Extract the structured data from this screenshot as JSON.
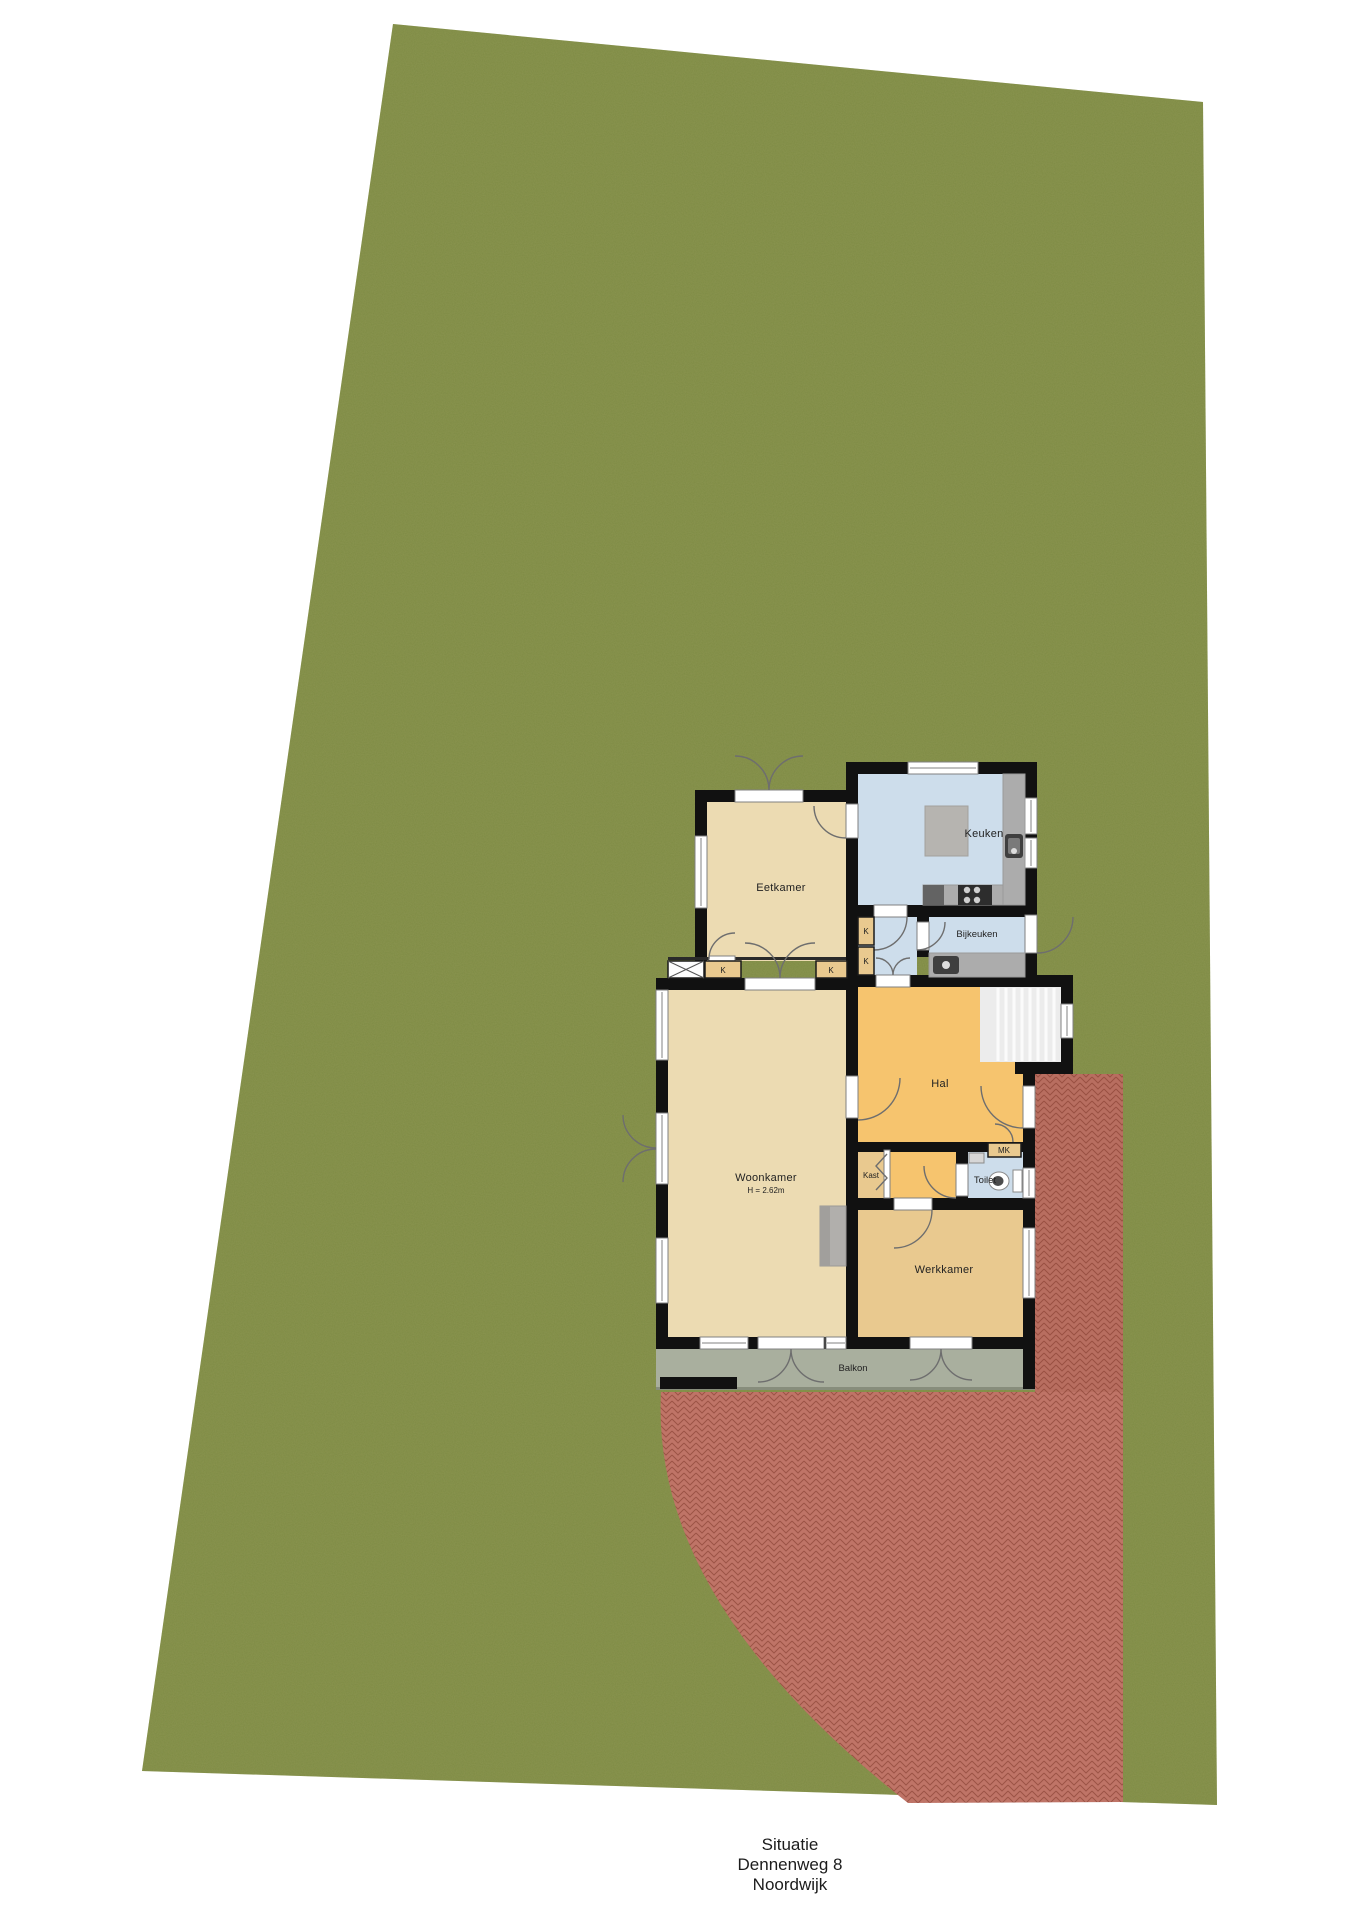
{
  "caption": {
    "line1": "Situatie",
    "line2": "Dennenweg 8",
    "line3": "Noordwijk"
  },
  "rooms": {
    "eetkamer": "Eetkamer",
    "keuken": "Keuken",
    "bijkeuken": "Bijkeuken",
    "hal": "Hal",
    "woonkamer": "Woonkamer",
    "woonkamer_ceiling": "H = 2.62m",
    "werkkamer": "Werkkamer",
    "kast": "Kast",
    "toilet": "Toilet",
    "mk": "MK",
    "balkon": "Balkon",
    "closet_abbr": "K"
  },
  "colors": {
    "grass": "#7e8b44",
    "terrace": "#bf7467",
    "terrace-line": "#9c5346",
    "floor-beige": "#ecdbb2",
    "floor-tan": "#e9c98f",
    "floor-orange": "#f6c46e",
    "floor-blue": "#cdddeb",
    "balkon": "#a9af9e",
    "wall": "#111111",
    "counter": "#acacac",
    "stairs": "#ececec",
    "label": "#222222"
  }
}
